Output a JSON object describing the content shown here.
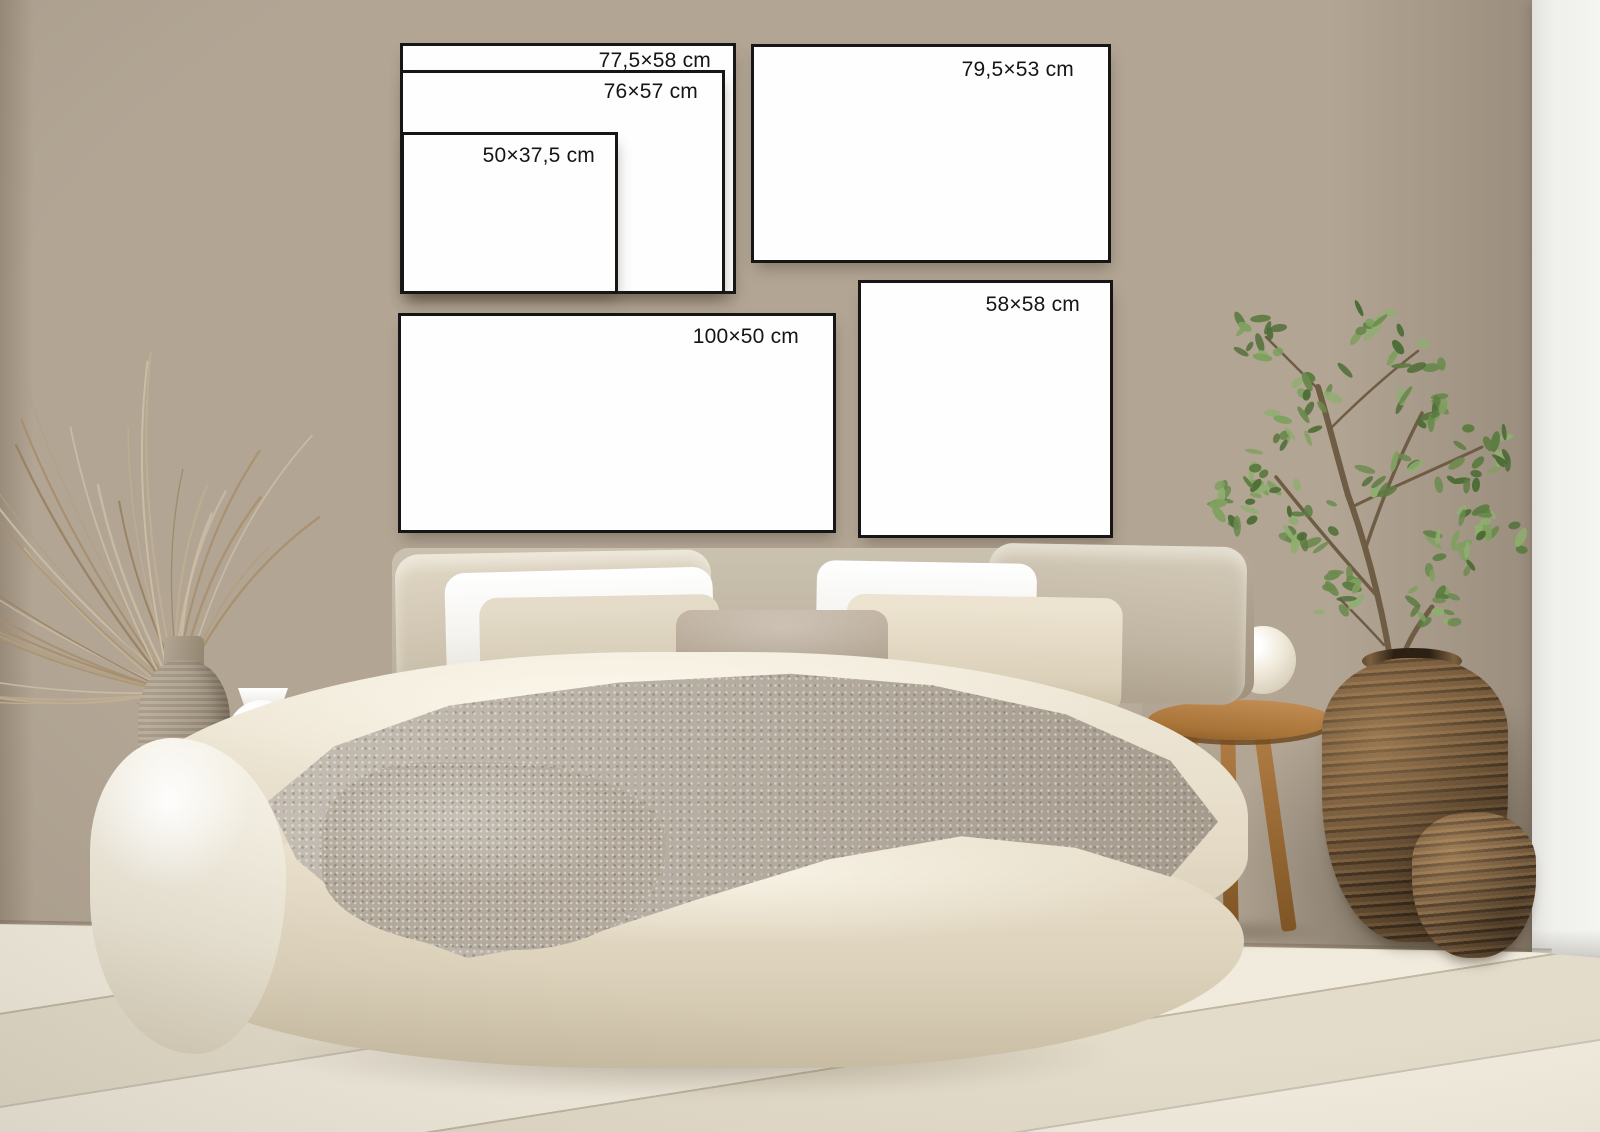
{
  "frames": {
    "f77": {
      "label": "77,5×58 cm"
    },
    "f76": {
      "label": "76×57 cm"
    },
    "f50": {
      "label": "50×37,5 cm"
    },
    "f79": {
      "label": "79,5×53 cm"
    },
    "f58": {
      "label": "58×58 cm"
    },
    "f100": {
      "label": "100×50 cm"
    }
  },
  "colors": {
    "wall_beige": "#b2a594",
    "wall_shadow": "#978a7a",
    "white_wall": "#efefec",
    "floor": "#ece5d4",
    "frame_background": "#fefefe",
    "frame_border": "#161616",
    "label_text": "#151515",
    "wicker_light": "#bd8d54",
    "wicker_dark": "#6e563a",
    "wood_stool": "#a87438",
    "bedding_cream": "#e9e0cd",
    "throw_grey": "#b8afa2",
    "plant_greens": [
      "#4e6d36",
      "#5d7c41",
      "#6b8a4e",
      "#7fa05f",
      "#8fae70"
    ],
    "grass_tans": [
      "#cdbfa6",
      "#c2b093",
      "#b49f7f",
      "#a78f6d",
      "#97805f"
    ],
    "branch_brown": "#6f5c44"
  }
}
